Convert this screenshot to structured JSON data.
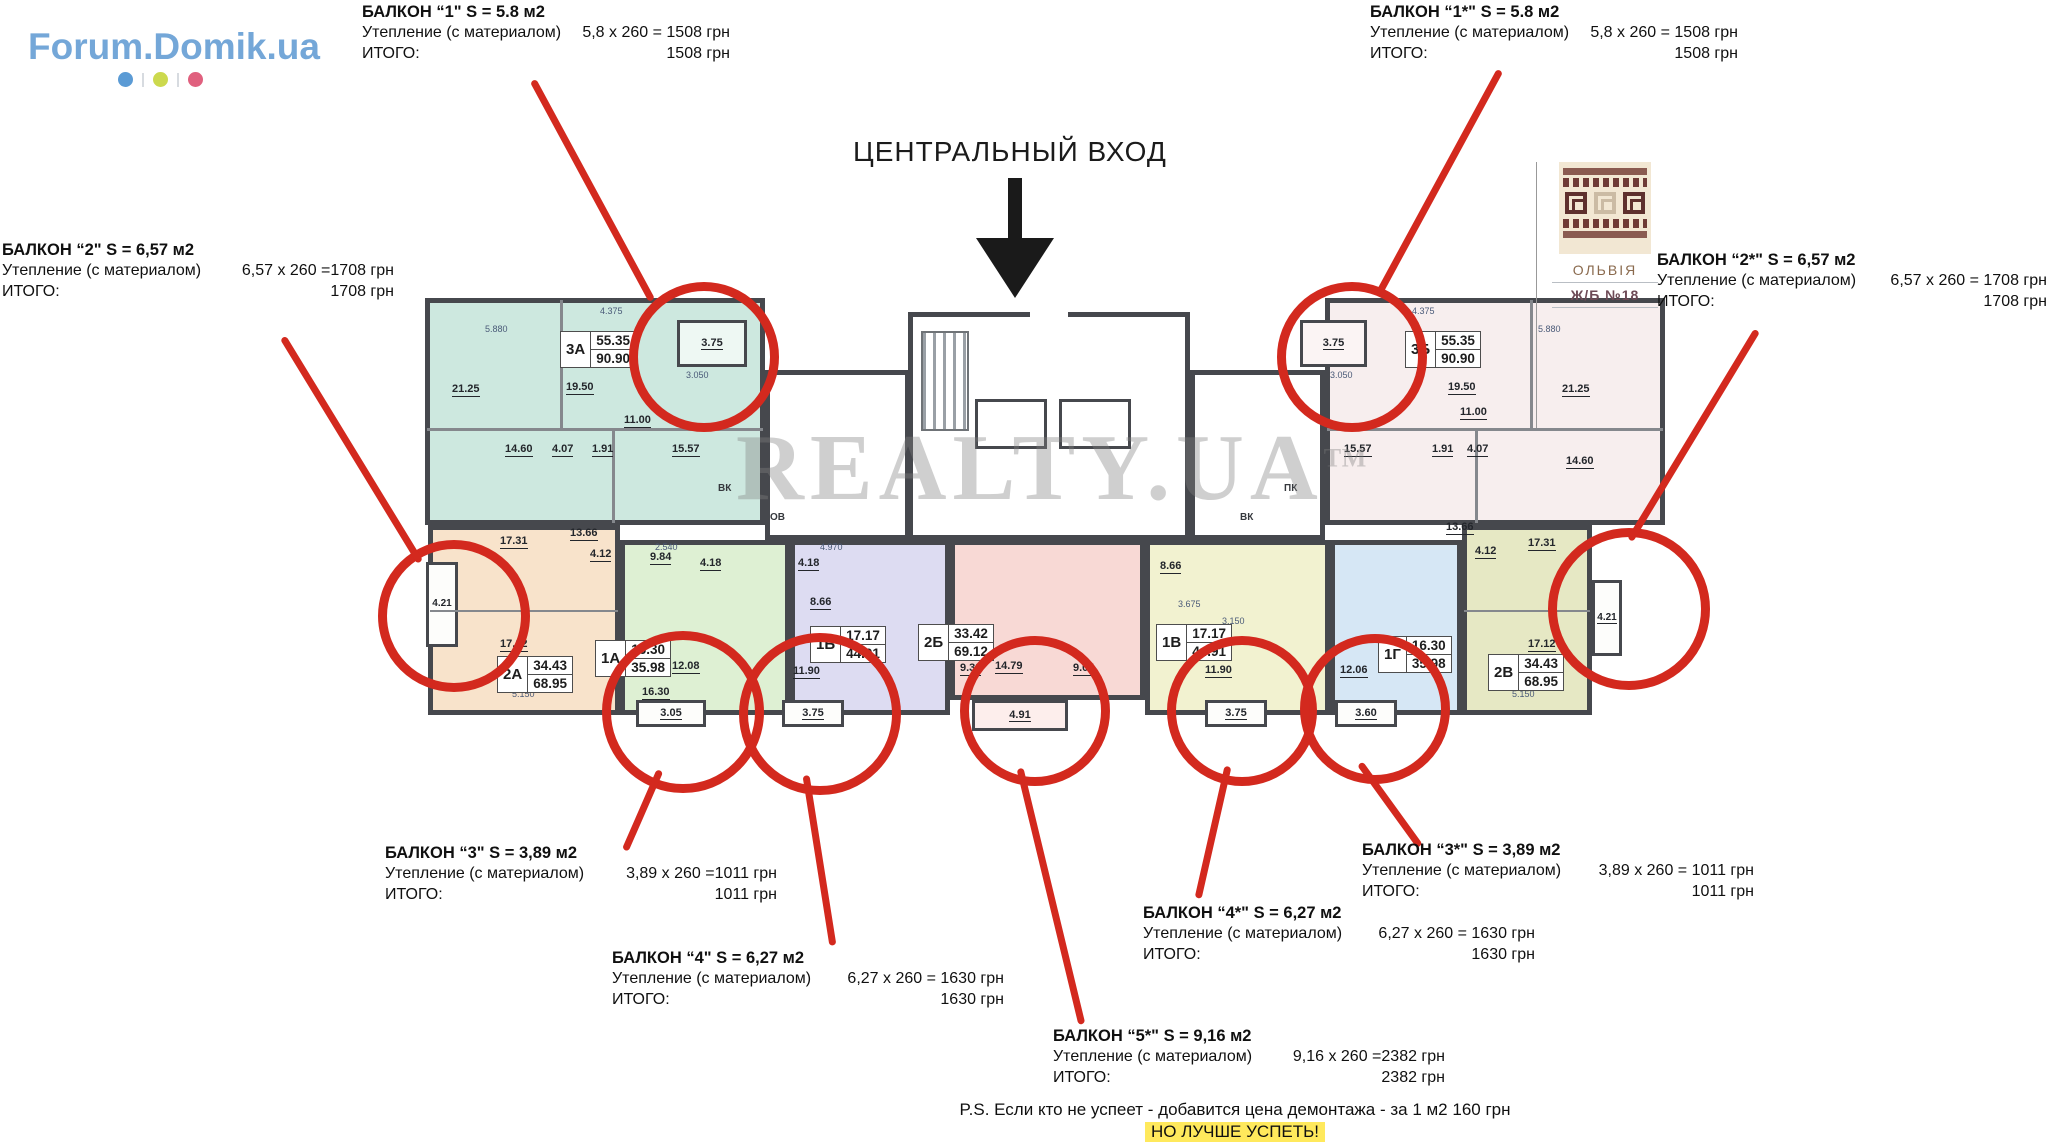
{
  "logo": {
    "text": "Forum.Domik.ua",
    "dot_colors": [
      "#5b9bd5",
      "#ccd94e",
      "#e0607e"
    ]
  },
  "entrance": {
    "label": "ЦЕНТРАЛЬНЫЙ ВХОД"
  },
  "badge": {
    "name": "ОЛЬВІЯ",
    "unit": "Ж/Б №18"
  },
  "watermark": {
    "text": "REALTY.UA",
    "tm": "ТМ"
  },
  "annotations": {
    "b1": {
      "title": "БАЛКОН “1\" S = 5.8 м2",
      "label": "Утепление (с материалом)",
      "calc": "5,8 x 260 = 1508 грн",
      "total_label": "ИТОГО:",
      "total": "1508 грн"
    },
    "b1s": {
      "title": "БАЛКОН “1*\" S = 5.8 м2",
      "label": "Утепление (с материалом)",
      "calc": "5,8 x 260 = 1508 грн",
      "total_label": "ИТОГО:",
      "total": "1508  грн"
    },
    "b2": {
      "title": "БАЛКОН “2\" S = 6,57 м2",
      "label": "Утепление (с материалом)",
      "calc": "6,57 x 260 =1708 грн",
      "total_label": "ИТОГО:",
      "total": "1708 грн"
    },
    "b2s": {
      "title": "БАЛКОН “2*\" S = 6,57 м2",
      "label": "Утепление (с материалом)",
      "calc": "6,57 x 260 = 1708 грн",
      "total_label": "ИТОГО:",
      "total": "1708 грн"
    },
    "b3": {
      "title": "БАЛКОН “3\" S = 3,89 м2",
      "label": "Утепление (с материалом)",
      "calc": "3,89 x 260 =1011  грн",
      "total_label": "ИТОГО:",
      "total": "1011 грн"
    },
    "b4": {
      "title": "БАЛКОН “4\" S = 6,27 м2",
      "label": "Утепление (с материалом)",
      "calc": "6,27 x 260 = 1630 грн",
      "total_label": "ИТОГО:",
      "total": "1630 грн"
    },
    "b5s": {
      "title": "БАЛКОН “5*\" S = 9,16 м2",
      "label": "Утепление (с материалом)",
      "calc": "9,16 x 260 =2382 грн",
      "total_label": "ИТОГО:",
      "total": "2382 грн"
    },
    "b4s": {
      "title": "БАЛКОН “4*\" S = 6,27 м2",
      "label": "Утепление (с материалом)",
      "calc": "6,27 x 260 = 1630 грн",
      "total_label": "ИТОГО:",
      "total": "1630 грн"
    },
    "b3s": {
      "title": "БАЛКОН “3*\" S = 3,89 м2",
      "label": "Утепление (с материалом)",
      "calc": "3,89 x 260 = 1011 грн",
      "total_label": "ИТОГО:",
      "total": "1011 грн"
    }
  },
  "ps": {
    "line1": "P.S. Если кто не успеет - добавится цена демонтажа - за 1 м2 160 грн",
    "line2": "НО ЛУЧШЕ УСПЕТЬ!"
  },
  "plan": {
    "apartments": [
      {
        "unit": "3А",
        "area_living": "55.35",
        "area_total": "90.90",
        "color": "#cde8df",
        "rooms": [
          "21.25",
          "19.50",
          "11.00",
          "14.60",
          "4.07",
          "1.91",
          "15.57"
        ],
        "balcony": "3.75"
      },
      {
        "unit": "3Б",
        "area_living": "55.35",
        "area_total": "90.90",
        "color": "#f7eeee",
        "rooms": [
          "19.50",
          "21.25",
          "11.00",
          "15.57",
          "1.91",
          "4.07",
          "14.60"
        ],
        "balcony": "3.75"
      },
      {
        "unit": "2А",
        "area_living": "34.43",
        "area_total": "68.95",
        "color": "#f8e3cb",
        "rooms": [
          "17.31",
          "13.66",
          "4.12",
          "17.12"
        ],
        "balcony": "4.21"
      },
      {
        "unit": "1А",
        "area_living": "16.30",
        "area_total": "35.98",
        "color": "#def0d3",
        "rooms": [
          "9.84",
          "4.18",
          "16.30",
          "12.08"
        ],
        "balcony": "3.05"
      },
      {
        "unit": "1Б",
        "area_living": "17.17",
        "area_total": "44.91",
        "color": "#dddcf2",
        "rooms": [
          "4.18",
          "8.66",
          "11.90"
        ],
        "balcony": "3.75"
      },
      {
        "unit": "2Б",
        "area_living": "33.42",
        "area_total": "69.12",
        "color": "#f8d9d5",
        "rooms": [
          "9.38",
          "14.79",
          "9.04"
        ],
        "balcony": "4.91"
      },
      {
        "unit": "1В",
        "area_living": "17.17",
        "area_total": "44.91",
        "color": "#f2f2d0",
        "rooms": [
          "8.66",
          "11.90"
        ],
        "balcony": "3.75"
      },
      {
        "unit": "1Г",
        "area_living": "16.30",
        "area_total": "35.98",
        "color": "#d6e7f5",
        "rooms": [
          "12.06"
        ],
        "balcony": "3.60"
      },
      {
        "unit": "2В",
        "area_living": "34.43",
        "area_total": "68.95",
        "color": "#e6e8c4",
        "rooms": [
          "13.66",
          "4.12",
          "17.31",
          "17.12"
        ],
        "balcony": "4.21"
      }
    ],
    "dims": [
      "5.880",
      "4.375",
      "3.050",
      "4.375",
      "5.880",
      "3.050",
      "5.150",
      "5.150",
      "3.675",
      "2.540",
      "4.970",
      "3.150"
    ],
    "core_labels": [
      "ВК",
      "ОВ",
      "ПК",
      "ВК"
    ]
  },
  "colors": {
    "markup_red": "#d3291e",
    "wall": "#46484d",
    "logo_blue": "#74a7d8",
    "highlight_yellow": "#ffe95c",
    "badge_maroon": "#8a5a50"
  }
}
